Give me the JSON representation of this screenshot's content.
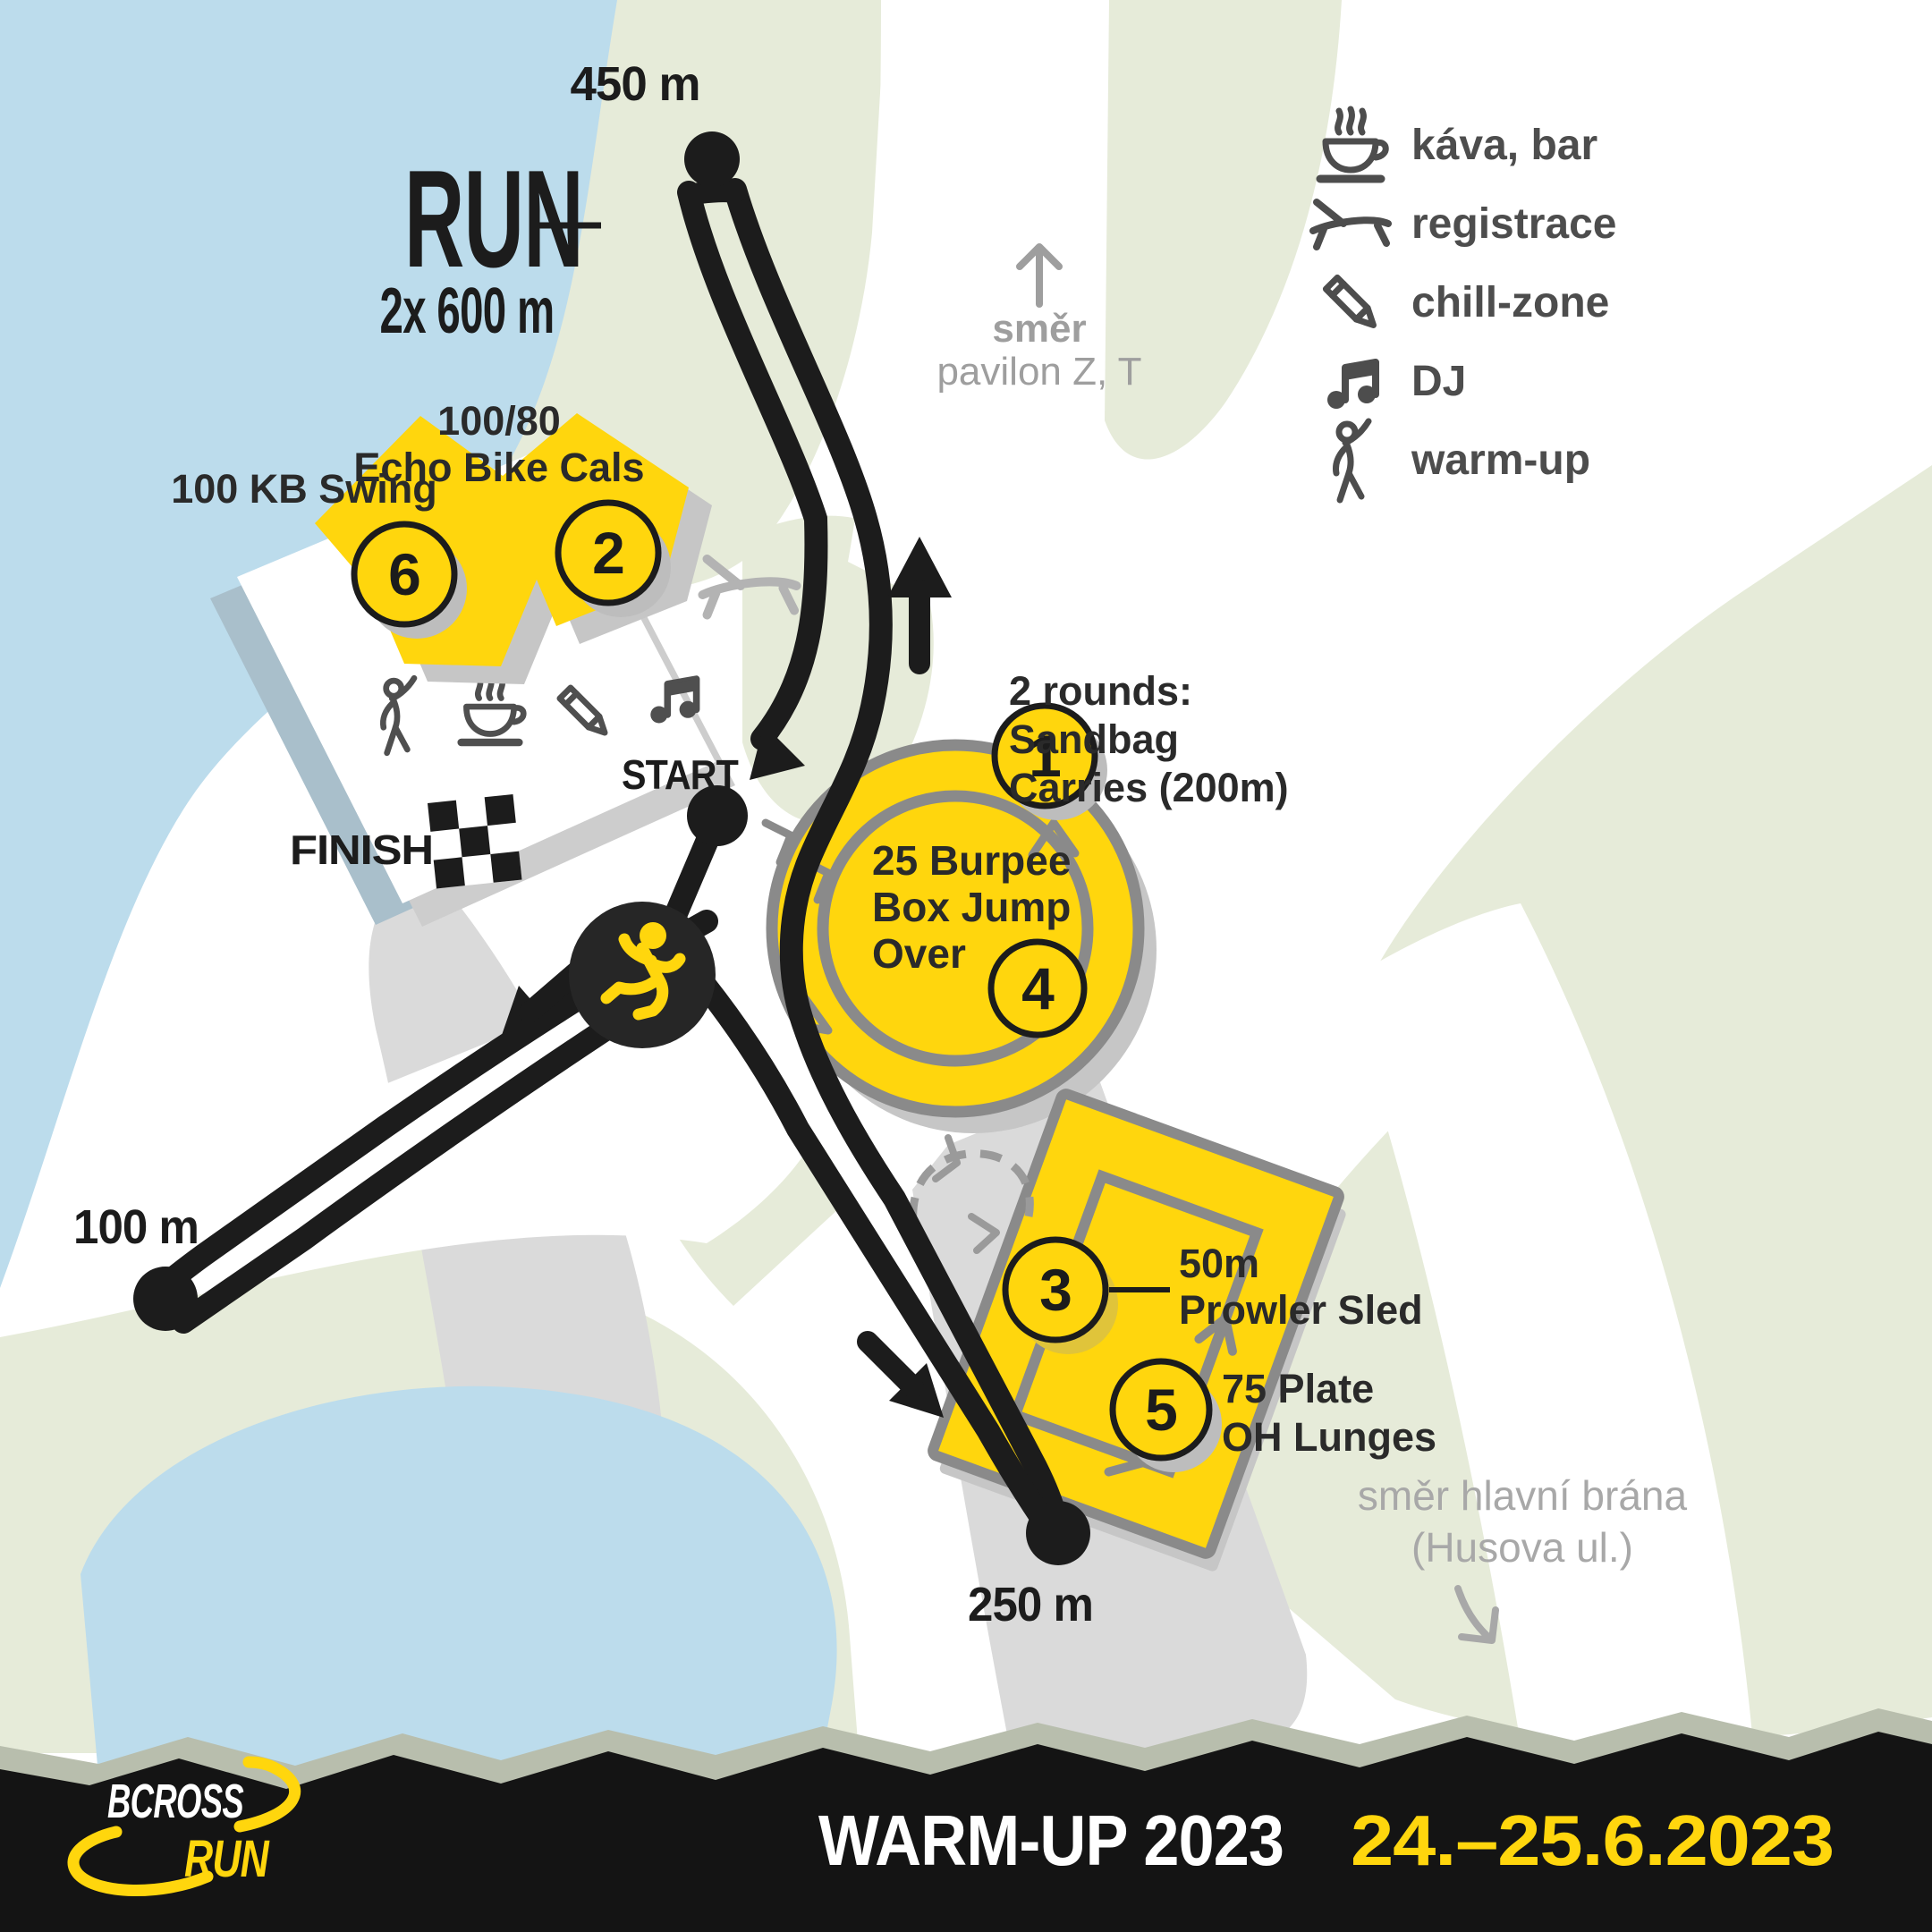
{
  "map": {
    "run_title": "RUN",
    "run_subtitle": "2x 600 m",
    "distances": {
      "top": "450 m",
      "left": "100 m",
      "bottom": "250 m"
    },
    "start_label": "START",
    "finish_label": "FINISH",
    "directions": {
      "pavilion": {
        "line1": "směr",
        "line2": "pavilon Z, T"
      },
      "gate": {
        "line1": "směr hlavní brána",
        "line2": "(Husova ul.)"
      }
    },
    "stations": [
      {
        "number": "1",
        "lines": [
          "2 rounds:",
          "Sandbag",
          "Carries (200m)"
        ]
      },
      {
        "number": "2",
        "lines": [
          "100/80",
          "Echo Bike Cals"
        ]
      },
      {
        "number": "3",
        "lines": [
          "50m",
          "Prowler Sled"
        ]
      },
      {
        "number": "4",
        "lines": [
          "25 Burpee",
          "Box Jump",
          "Over"
        ]
      },
      {
        "number": "5",
        "lines": [
          "75 Plate",
          "OH Lunges"
        ]
      },
      {
        "number": "6",
        "lines": [
          "100 KB Swing"
        ]
      }
    ]
  },
  "legend": {
    "items": [
      {
        "icon": "coffee-icon",
        "label": "káva, bar"
      },
      {
        "icon": "lounge-chair-icon",
        "label": "registrace"
      },
      {
        "icon": "pencil-icon",
        "label": "chill-zone"
      },
      {
        "icon": "music-note-icon",
        "label": "DJ"
      },
      {
        "icon": "warmup-person-icon",
        "label": "warm-up"
      }
    ]
  },
  "footer": {
    "brand_line1": "BCROSS",
    "brand_line2": "RUN",
    "event_title": "WARM-UP 2023",
    "event_date": "24.–25.6.2023"
  },
  "colors": {
    "accent_yellow": "#ffd60d",
    "course_black": "#1c1c1c",
    "water_blue": "#bcdcec",
    "land_green": "#e6ebd9",
    "road_gray": "#dadada",
    "icon_gray": "#4d4d4d",
    "muted_gray": "#9e9e9e",
    "ring_gray": "#8a8a8a",
    "footer_black": "#141414"
  }
}
